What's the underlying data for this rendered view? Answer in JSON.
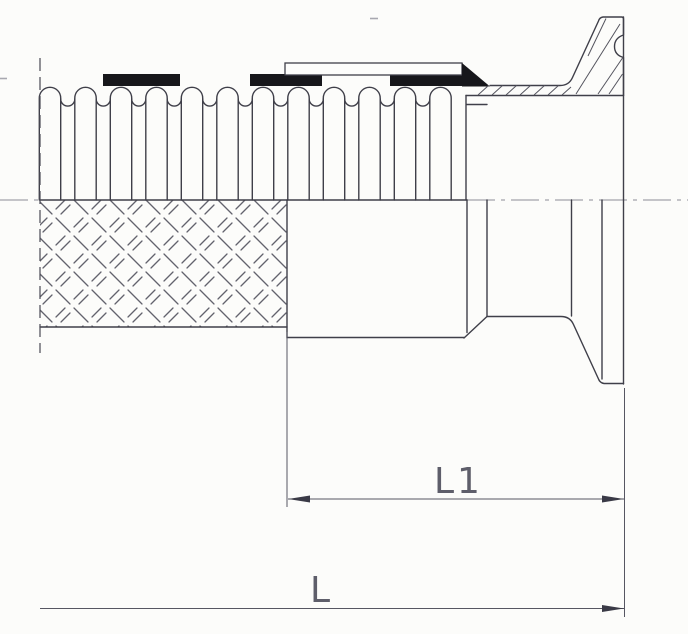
{
  "drawing": {
    "dimensions": {
      "l1": {
        "label": "L1"
      },
      "l": {
        "label": "L"
      }
    },
    "colors": {
      "line": "#3f3f49",
      "dimension_line": "#565662",
      "dimension_text": "#5e5e6a",
      "solid_fill": "#17171b",
      "centerline": "#8b8b95",
      "background": "#fcfcfa"
    }
  }
}
